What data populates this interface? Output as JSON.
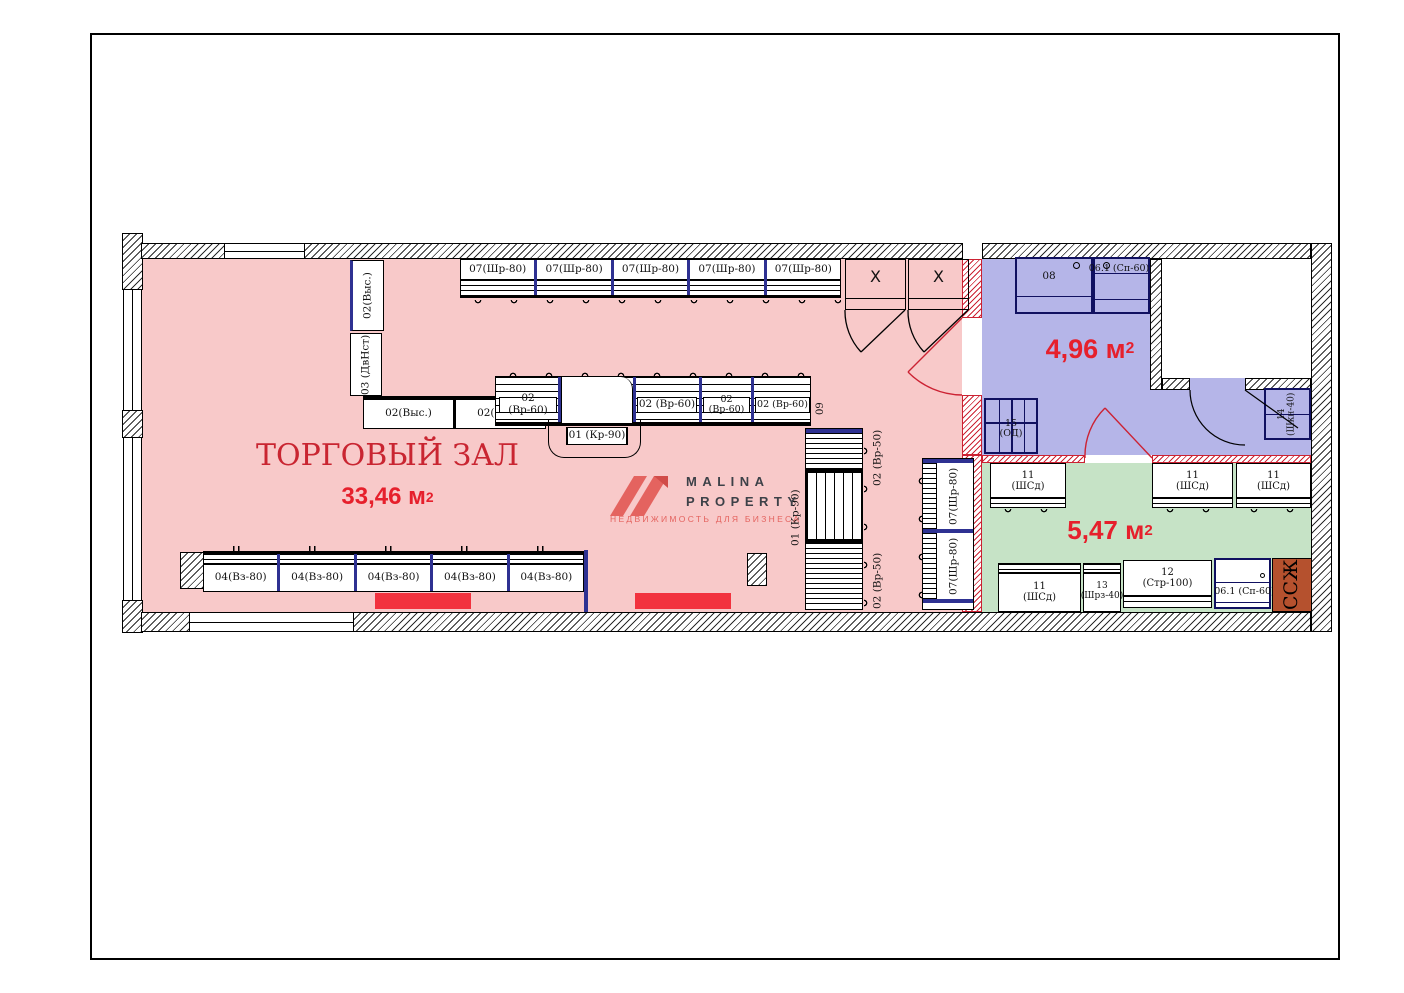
{
  "colors": {
    "hall_fill": "#f8c9c9",
    "back_room_fill": "#b5b5e8",
    "green_room_fill": "#c6e3c6",
    "accent_red_text": "#e6202c",
    "title_red": "#c92531",
    "door_red": "#cc2233",
    "divider_blue": "#2e3192",
    "shaft_terracotta": "#b5512e",
    "red_marker": "#f2323e",
    "logo_salmon": "#e4635f",
    "logo_gray": "#3d4148"
  },
  "hall": {
    "title": "ТОРГОВЫЙ ЗАЛ",
    "area_value": "33,46 м",
    "area_sup": "2",
    "top_shelves": [
      "07(Шр-80)",
      "07(Шр-80)",
      "07(Шр-80)",
      "07(Шр-80)",
      "07(Шр-80)"
    ],
    "fitting_room_mark_1": "X",
    "fitting_room_mark_2": "X",
    "wall_shelf_vertical_1": "02(Выс.)",
    "wall_shelf_vertical_2": "03 (ДвНст)",
    "mid_shelves_left": [
      "02(Выс.)",
      "02(Выс.)"
    ],
    "mid_shelves_right": [
      "02 (Вр-60)",
      "02 (Вр-60)",
      "02 (Вр-60)",
      "02 (Вр-60)"
    ],
    "cash_desk": "01 (Кр-90)",
    "island_top_label": "09",
    "bottom_shelves": [
      "04(Вз-80)",
      "04(Вз-80)",
      "04(Вз-80)",
      "04(Вз-80)",
      "04(Вз-80)"
    ],
    "island_a_label_top": "02 (Вр-50)",
    "island_a_label_mid": "01 (Кр-90)",
    "island_a_label_bottom": "02 (Вр-50)",
    "island_b_labels": [
      "07(Шр-80)",
      "07(Шр-80)"
    ]
  },
  "back_room": {
    "area_value": "4,96 м",
    "area_sup": "2",
    "cabinet_left": "08",
    "cabinet_right": "06.1 (Сп-60)",
    "door_unit": "15\n(ОД)",
    "corner_unit": "14\n(Шкн-40)"
  },
  "green_room": {
    "area_value": "5,47 м",
    "area_sup": "2",
    "cabinets_top": [
      "11\n(ШСд)",
      "11\n(ШСд)",
      "11\n(ШСд)"
    ],
    "cabinet_bottom_1": "11\n(ШСд)",
    "cabinet_bottom_2": "13\n(Шрз-40)",
    "counter": "12\n(Стр-100)",
    "sink_unit": "06.1 (Сп-60)",
    "shaft": "ССЖ"
  },
  "logo": {
    "name_line1": "MALINA",
    "name_line2": "PROPERTY",
    "tagline": "НЕДВИЖИМОСТЬ ДЛЯ БИЗНЕСА"
  }
}
